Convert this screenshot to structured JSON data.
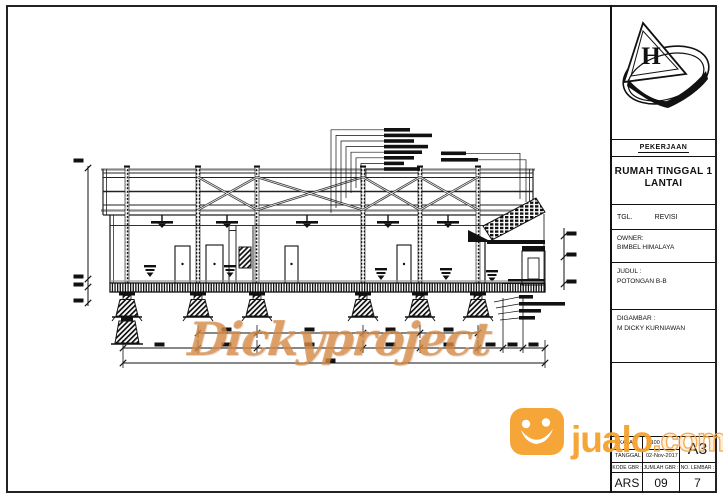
{
  "titleblock": {
    "logo_letter": "H",
    "pekerjaan_label": "PEKERJAAN",
    "project_title_line1": "RUMAH TINGGAL 1",
    "project_title_line2": "LANTAI",
    "tgl_label": "TGL.",
    "revisi_label": "REVISI",
    "owner_label": "OWNER:",
    "owner_value": "BIMBEL HIMALAYA",
    "judul_label": "JUDUL :",
    "judul_value": "POTONGAN B-B",
    "digambar_label": "DIGAMBAR :",
    "digambar_value": "M DICKY KURNIAWAN",
    "skala_label": "SKALA",
    "skala_value": "1:100",
    "tanggal_label": "TANGGAL",
    "tanggal_value": "02-Nov-2017",
    "paper_size": "A3",
    "kode_gbr_label": "KODE GBR :",
    "jumlah_gbr_label": "JUMLAH GBR :",
    "no_lembar_label": "NO. LEMBAR :",
    "kode_gbr_value": "ARS",
    "jumlah_gbr_value": "09",
    "no_lembar_value": "7"
  },
  "watermark": {
    "text": "Dickyproject",
    "color": "#D78C48"
  },
  "jualo": {
    "name": "jualo",
    "tld": ".com",
    "brand_color": "#F6A22E"
  }
}
